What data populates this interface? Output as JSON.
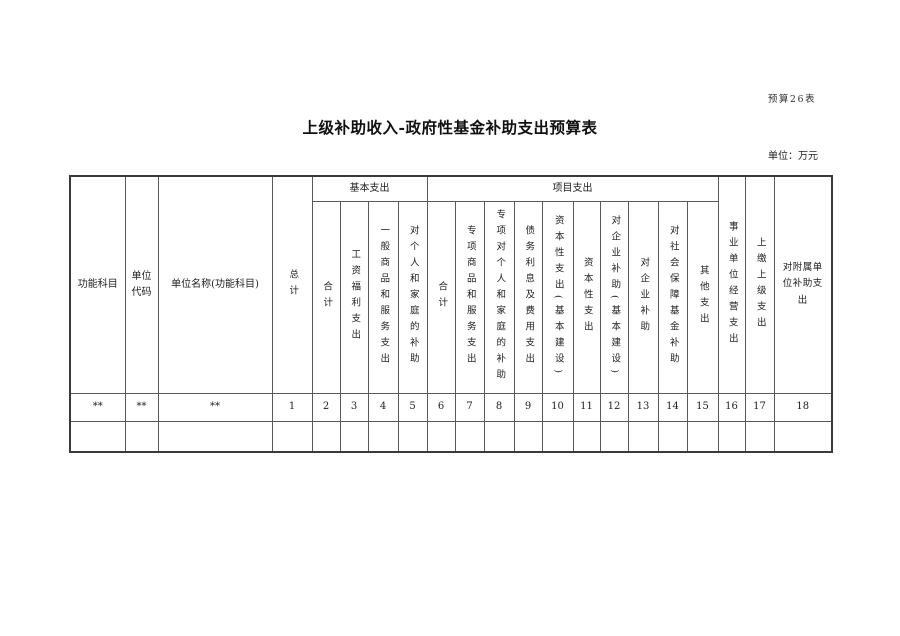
{
  "page": {
    "form_label": "预算26表",
    "title": "上级补助收入-政府性基金补助支出预算表",
    "unit_label": "单位：万元"
  },
  "table": {
    "header": {
      "function_category": "功能科目",
      "unit_code": "单位代码",
      "unit_name": "单位名称(功能科目)",
      "grand_total": "总计",
      "group_basic": "基本支出",
      "group_project": "项目支出",
      "basic": [
        "合计",
        "工资福利支出",
        "一般商品和服务支出",
        "对个人和家庭的补助"
      ],
      "project": [
        "合计",
        "专项商品和服务支出",
        "专项对个人和家庭的补助",
        "债务利息及费用支出",
        "资本性支出(基本建设)",
        "资本性支出",
        "对企业补助(基本建设)",
        "对企业补助",
        "对社会保障基金补助",
        "其他支出"
      ],
      "business_operation": "事业单位经营支出",
      "remit_superior": "上缴上级支出",
      "affiliated_subsidy": "对附属单位补助支出"
    },
    "code_row": [
      "**",
      "**",
      "**",
      "1",
      "2",
      "3",
      "4",
      "5",
      "6",
      "7",
      "8",
      "9",
      "10",
      "11",
      "12",
      "13",
      "14",
      "15",
      "16",
      "17",
      "18"
    ],
    "data_rows": [
      [
        "",
        "",
        "",
        "",
        "",
        "",
        "",
        "",
        "",
        "",
        "",
        "",
        "",
        "",
        "",
        "",
        "",
        "",
        "",
        "",
        ""
      ]
    ]
  }
}
